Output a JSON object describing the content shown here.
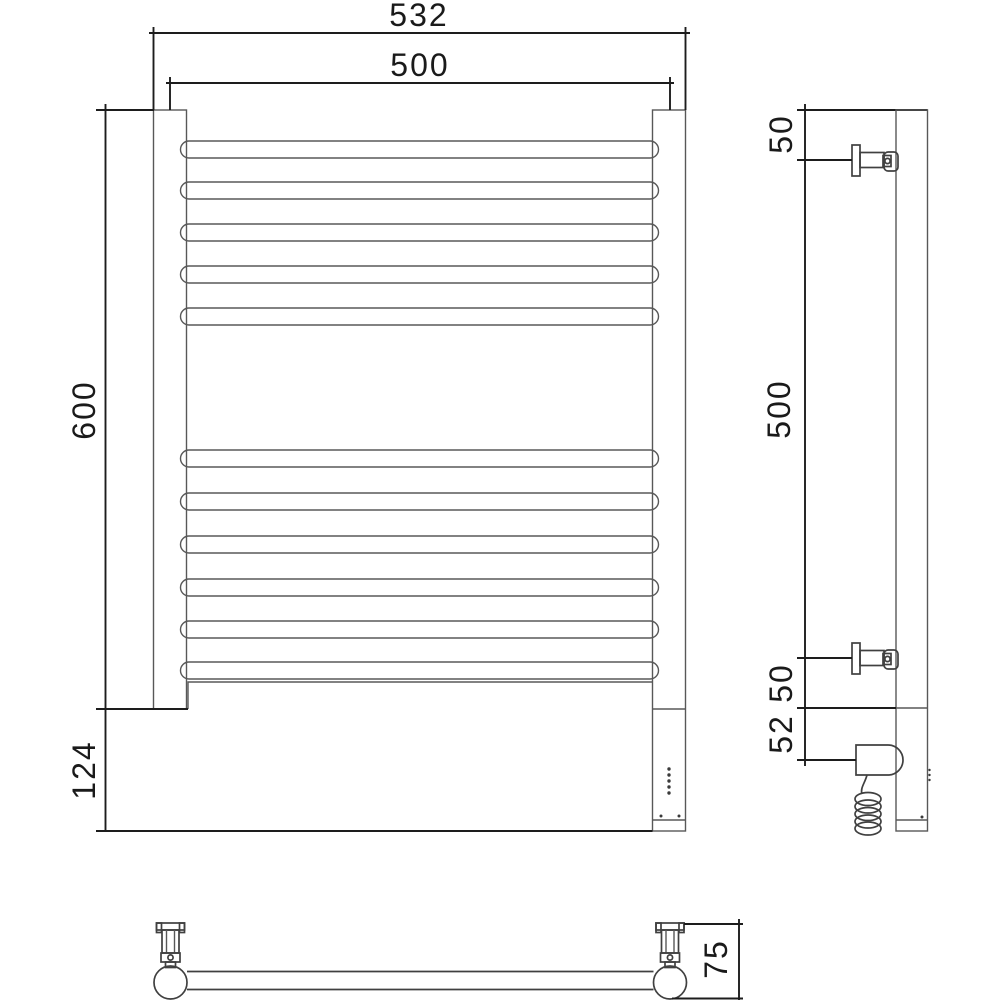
{
  "drawing": {
    "type": "technical-drawing",
    "subject": "electric heated towel rail, three orthographic views with dimensions",
    "colors": {
      "background": "#ffffff",
      "geometry_line": "#585858",
      "detail_line": "#404040",
      "dimension_line": "#1d1d1d",
      "text": "#1a1a1a"
    },
    "front_view": {
      "bars_top_group": 5,
      "bars_bottom_group": 6,
      "led_dots": 5,
      "dims": {
        "overall_width": "532",
        "tube_span": "500",
        "rail_height": "600",
        "housing_height": "124"
      }
    },
    "side_view": {
      "dims": {
        "top_to_upper_bracket": "50",
        "bracket_to_bracket": "500",
        "lower_bracket_to_base": "50",
        "base_to_element": "52"
      }
    },
    "bottom_view": {
      "dims": {
        "wall_depth": "75"
      }
    }
  }
}
